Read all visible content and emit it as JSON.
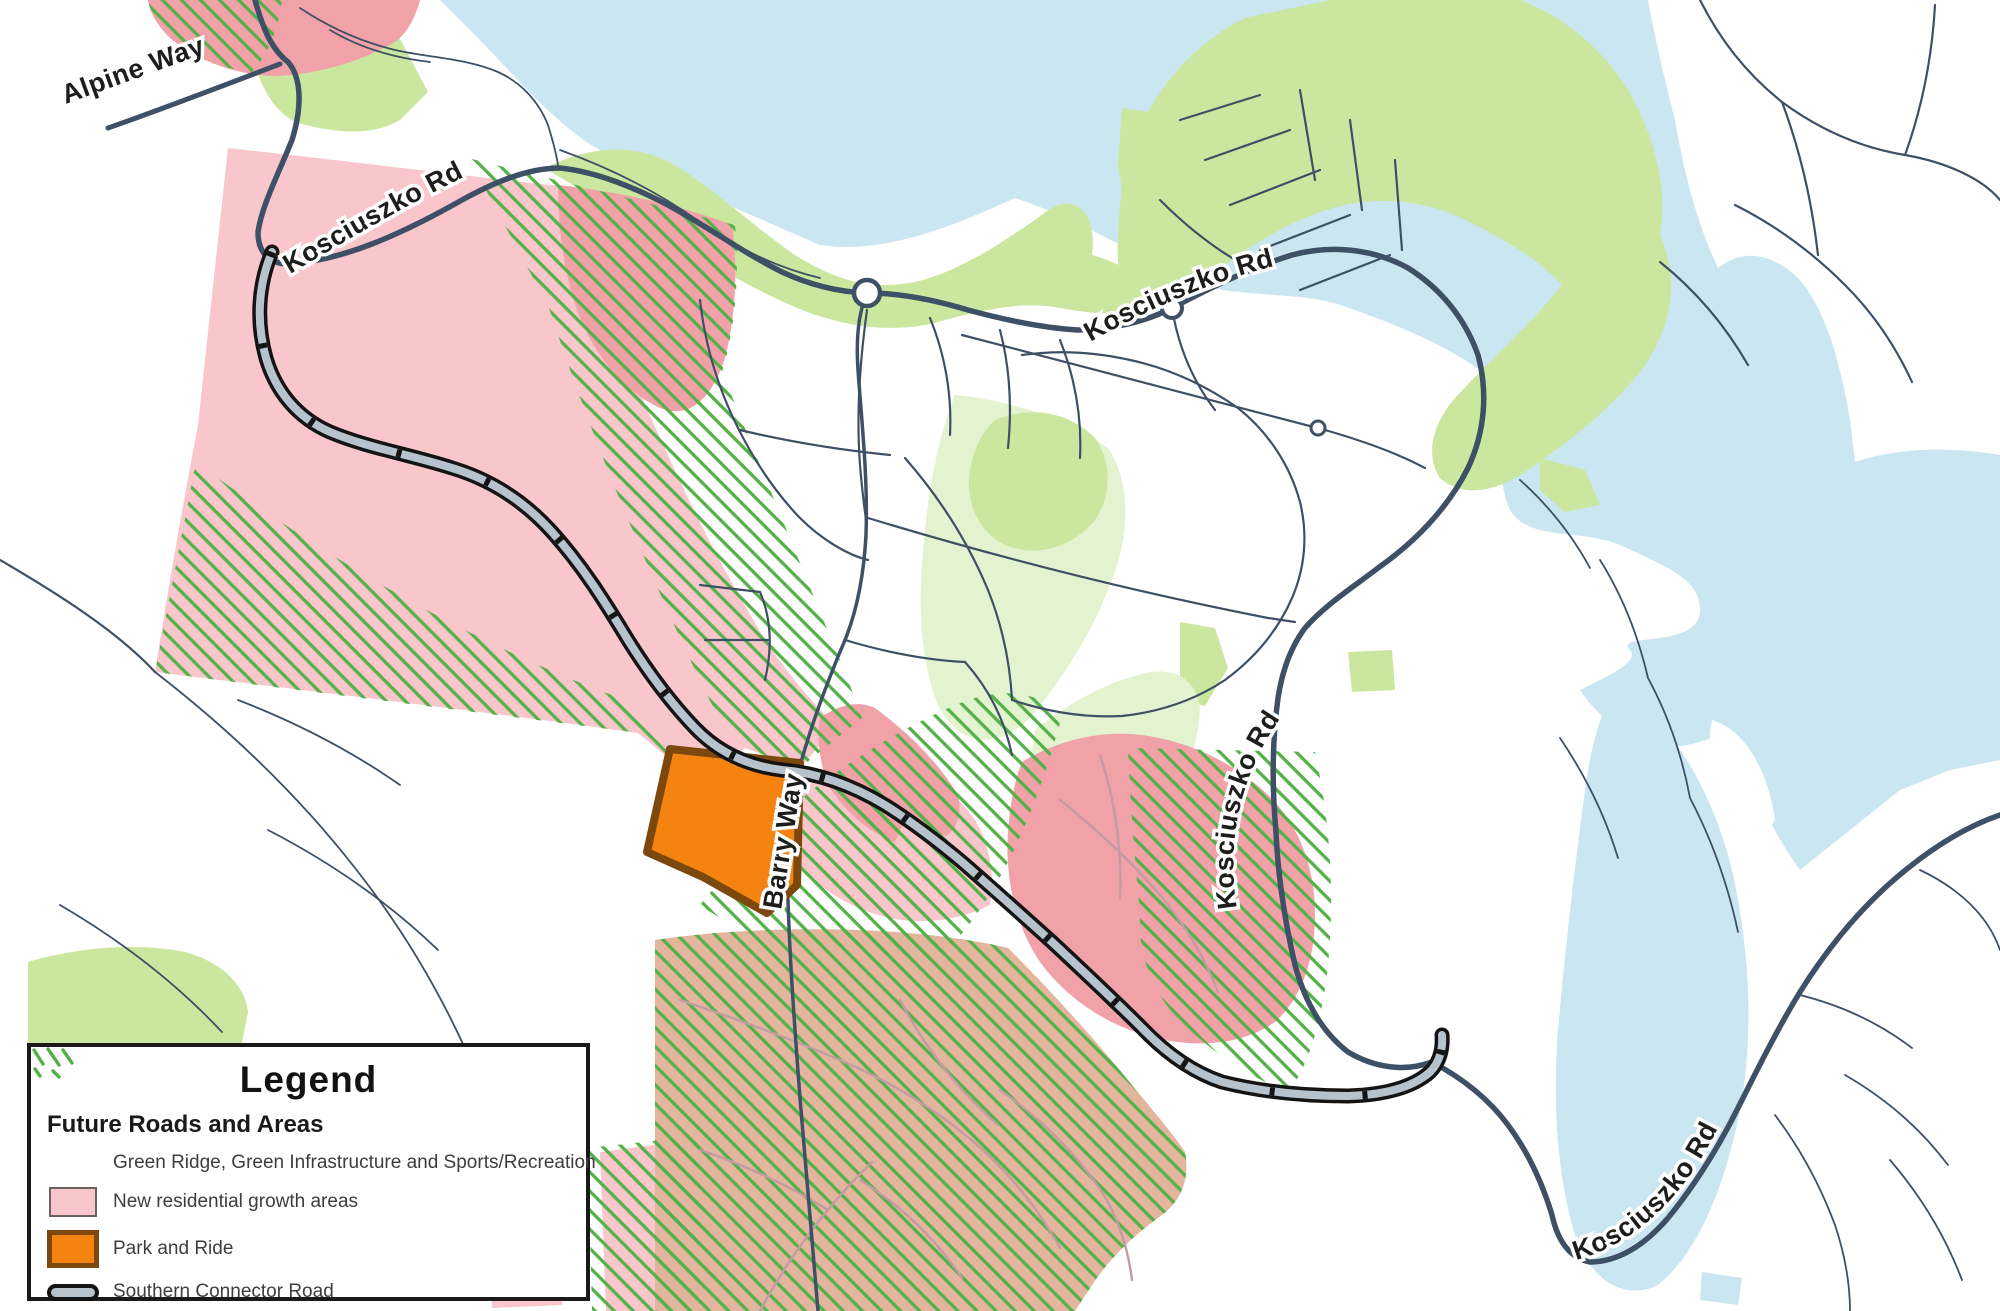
{
  "map": {
    "road_labels": [
      {
        "id": "alpine-way",
        "text": "Alpine Way"
      },
      {
        "id": "kosciuszko-rd-nw",
        "text": "Kosciuszko Rd"
      },
      {
        "id": "kosciuszko-rd-north",
        "text": "Kosciuszko Rd"
      },
      {
        "id": "kosciuszko-rd-east",
        "text": "Kosciuszko Rd"
      },
      {
        "id": "kosciuszko-rd-south",
        "text": "Kosciuszko Rd"
      },
      {
        "id": "barry-way",
        "text": "Barry Way"
      }
    ],
    "colors": {
      "background": "#ffffff",
      "lake": "#c9e6f1",
      "green_area": "#cbe79f",
      "green_light": "#e4f3cf",
      "hatch_green": "#54b148",
      "pink_pale": "#f8c6cb",
      "pink_salmon": "#f1a1a8",
      "tan": "#e3b59e",
      "road": "#3e5065",
      "road_faded": "#c29ba4",
      "connector_fill": "#b6c2cc",
      "connector_casing": "#141414",
      "park_and_ride_fill": "#f5830f",
      "park_and_ride_border": "#7d480e",
      "label_text": "#1d1d1b"
    }
  },
  "legend": {
    "title": "Legend",
    "section_title": "Future Roads and Areas",
    "items": [
      {
        "symbol": "green-hatch",
        "label": "Green Ridge, Green Infrastructure and Sports/Recreation"
      },
      {
        "symbol": "pink-swatch",
        "label": "New residential growth areas"
      },
      {
        "symbol": "orange-swatch",
        "label": "Park and Ride"
      },
      {
        "symbol": "road-symbol",
        "label": "Southern Connector Road"
      }
    ]
  }
}
